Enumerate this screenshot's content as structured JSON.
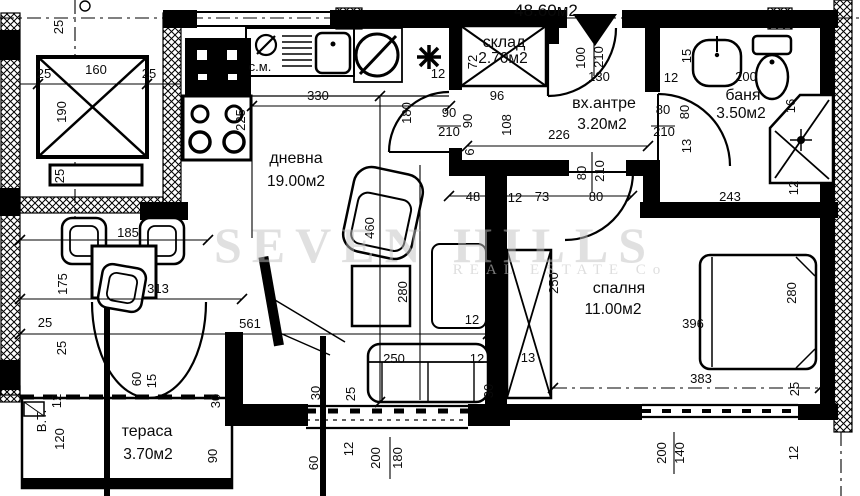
{
  "header": {
    "total_area": "48.60м2"
  },
  "watermark": {
    "line1": "SEVEN HILLS",
    "line2": "REAL ESTATE Co"
  },
  "rooms": [
    {
      "name": "дневна",
      "area": "19.00м2"
    },
    {
      "name": "вх.антре",
      "area": "3.20м2"
    },
    {
      "name": "баня",
      "area": "3.50м2"
    },
    {
      "name": "спалня",
      "area": "11.00м2"
    },
    {
      "name": "тераса",
      "area": "3.70м2"
    },
    {
      "name": "склад",
      "area": "2.70м2"
    }
  ],
  "colors": {
    "ink": "#000000",
    "paper": "#ffffff",
    "watermark": "#c2c2c2"
  },
  "dimensions": [
    {
      "t": "25",
      "x": 63,
      "y": 27,
      "r": -90
    },
    {
      "t": "25",
      "x": 44,
      "y": 78
    },
    {
      "t": "160",
      "x": 96,
      "y": 74
    },
    {
      "t": "25",
      "x": 149,
      "y": 78
    },
    {
      "t": "190",
      "x": 66,
      "y": 112,
      "r": -90
    },
    {
      "t": "25",
      "x": 64,
      "y": 176,
      "r": -90
    },
    {
      "t": "с.м.",
      "x": 260,
      "y": 71
    },
    {
      "t": "330",
      "x": 318,
      "y": 100
    },
    {
      "t": "225",
      "x": 245,
      "y": 120,
      "r": -90
    },
    {
      "t": "12",
      "x": 438,
      "y": 78
    },
    {
      "t": "180",
      "x": 411,
      "y": 113,
      "r": -90
    },
    {
      "t": "90",
      "x": 449,
      "y": 117
    },
    {
      "t": "210",
      "x": 449,
      "y": 136
    },
    {
      "t": "460",
      "x": 374,
      "y": 228,
      "r": -90
    },
    {
      "t": "280",
      "x": 407,
      "y": 292,
      "r": -90
    },
    {
      "t": "185",
      "x": 128,
      "y": 237
    },
    {
      "t": "313",
      "x": 158,
      "y": 293
    },
    {
      "t": "175",
      "x": 67,
      "y": 284,
      "r": -90
    },
    {
      "t": "25",
      "x": 45,
      "y": 327
    },
    {
      "t": "25",
      "x": 66,
      "y": 348,
      "r": -90
    },
    {
      "t": "561",
      "x": 250,
      "y": 328
    },
    {
      "t": "60",
      "x": 141,
      "y": 379,
      "r": -90
    },
    {
      "t": "15",
      "x": 156,
      "y": 381,
      "r": -90
    },
    {
      "t": "30",
      "x": 220,
      "y": 401,
      "r": -90
    },
    {
      "t": "250",
      "x": 394,
      "y": 363
    },
    {
      "t": "12",
      "x": 477,
      "y": 363
    },
    {
      "t": "13",
      "x": 528,
      "y": 362
    },
    {
      "t": "12",
      "x": 472,
      "y": 324
    },
    {
      "t": "30",
      "x": 320,
      "y": 393,
      "r": -90
    },
    {
      "t": "25",
      "x": 355,
      "y": 394,
      "r": -90
    },
    {
      "t": "72",
      "x": 477,
      "y": 62,
      "r": -90
    },
    {
      "t": "90",
      "x": 472,
      "y": 121,
      "r": -90
    },
    {
      "t": "6",
      "x": 474,
      "y": 152,
      "r": -90
    },
    {
      "t": "96",
      "x": 497,
      "y": 100
    },
    {
      "t": "108",
      "x": 511,
      "y": 125,
      "r": -90
    },
    {
      "t": "226",
      "x": 559,
      "y": 139
    },
    {
      "t": "100",
      "x": 585,
      "y": 58,
      "r": -90
    },
    {
      "t": "210",
      "x": 603,
      "y": 57,
      "r": -90
    },
    {
      "t": "130",
      "x": 599,
      "y": 81
    },
    {
      "t": "12",
      "x": 671,
      "y": 82
    },
    {
      "t": "80",
      "x": 586,
      "y": 173,
      "r": -90
    },
    {
      "t": "210",
      "x": 604,
      "y": 171,
      "r": -90
    },
    {
      "t": "80",
      "x": 596,
      "y": 201
    },
    {
      "t": "48",
      "x": 473,
      "y": 201
    },
    {
      "t": "12",
      "x": 515,
      "y": 202
    },
    {
      "t": "73",
      "x": 542,
      "y": 201
    },
    {
      "t": "15",
      "x": 691,
      "y": 56,
      "r": -90
    },
    {
      "t": "200",
      "x": 746,
      "y": 81
    },
    {
      "t": "16",
      "x": 795,
      "y": 106,
      "r": -90
    },
    {
      "t": "80",
      "x": 663,
      "y": 114
    },
    {
      "t": "210",
      "x": 664,
      "y": 136
    },
    {
      "t": "80",
      "x": 689,
      "y": 112,
      "r": -90
    },
    {
      "t": "13",
      "x": 691,
      "y": 146,
      "r": -90
    },
    {
      "t": "243",
      "x": 730,
      "y": 201
    },
    {
      "t": "12",
      "x": 798,
      "y": 188,
      "r": -90
    },
    {
      "t": "250",
      "x": 558,
      "y": 283,
      "r": -90
    },
    {
      "t": "396",
      "x": 693,
      "y": 328
    },
    {
      "t": "280",
      "x": 796,
      "y": 293,
      "r": -90
    },
    {
      "t": "383",
      "x": 701,
      "y": 383
    },
    {
      "t": "25",
      "x": 799,
      "y": 389,
      "r": -90
    },
    {
      "t": "30",
      "x": 493,
      "y": 391,
      "r": -90
    },
    {
      "t": "200",
      "x": 666,
      "y": 453,
      "r": -90
    },
    {
      "t": "140",
      "x": 684,
      "y": 453,
      "r": -90
    },
    {
      "t": "12",
      "x": 798,
      "y": 453,
      "r": -90
    },
    {
      "t": "60",
      "x": 318,
      "y": 463,
      "r": -90
    },
    {
      "t": "12",
      "x": 353,
      "y": 449,
      "r": -90
    },
    {
      "t": "200",
      "x": 380,
      "y": 458,
      "r": -90
    },
    {
      "t": "180",
      "x": 402,
      "y": 458,
      "r": -90
    },
    {
      "t": "В.Т.",
      "x": 46,
      "y": 421,
      "r": -90
    },
    {
      "t": "12",
      "x": 61,
      "y": 401,
      "r": -90
    },
    {
      "t": "120",
      "x": 64,
      "y": 439,
      "r": -90
    },
    {
      "t": "90",
      "x": 217,
      "y": 456,
      "r": -90
    }
  ]
}
